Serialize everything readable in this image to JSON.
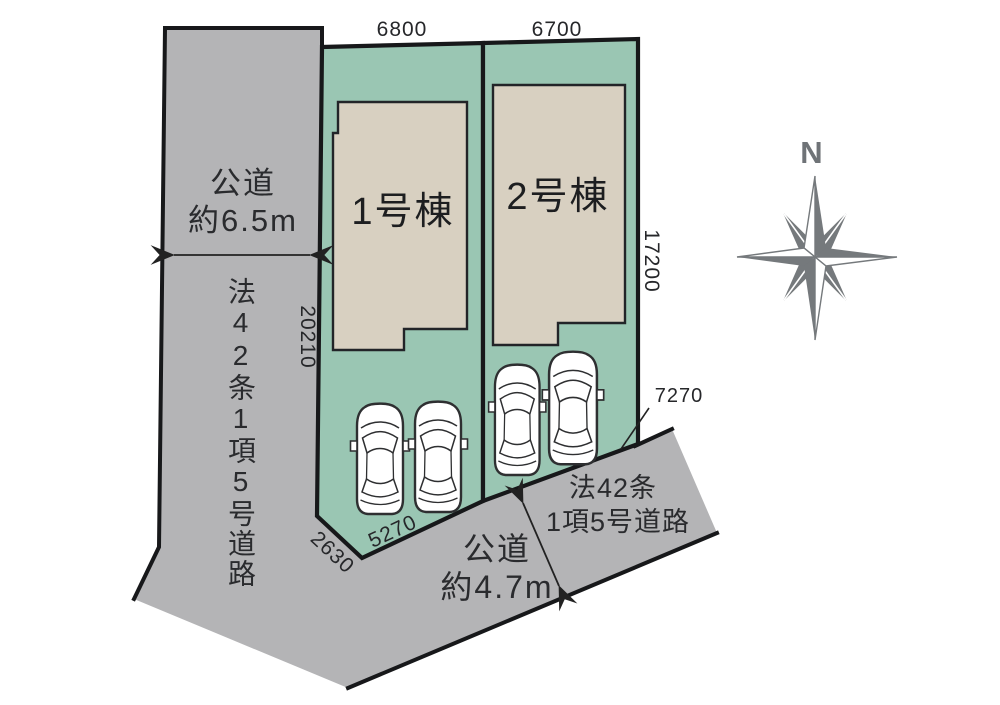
{
  "plan": {
    "buildings": [
      {
        "label": "1号棟"
      },
      {
        "label": "2号棟"
      }
    ],
    "dimensions": {
      "lot1_top": "6800",
      "lot2_top": "6700",
      "right_side": "17200",
      "left_side": "20210",
      "lot1_bottom": "5270",
      "corner_bevel": "2630",
      "road_frontage": "7270"
    },
    "roads": {
      "left": {
        "name": "公道",
        "width": "約6.5m",
        "law": "法42条1項5号道路"
      },
      "bottom": {
        "name": "公道",
        "width": "約4.7m",
        "law_line1": "法42条",
        "law_line2": "1項5号道路"
      }
    },
    "compass": {
      "north_label": "N"
    },
    "colors": {
      "lot_green": "#9ac6b3",
      "building_beige": "#d8d0c1",
      "road_gray": "#b4b4b6",
      "outline": "#17181a",
      "compass_gray": "#75797c",
      "car_body": "#ffffff"
    }
  }
}
